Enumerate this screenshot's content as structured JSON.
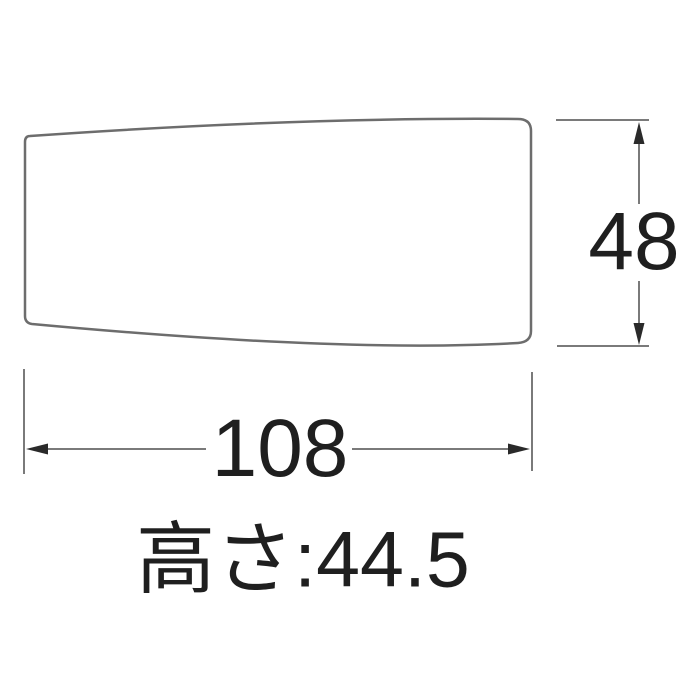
{
  "diagram": {
    "type": "technical-dimension-drawing",
    "part": "tapered-handle-side-view",
    "background_color": "#ffffff",
    "colors": {
      "outline": "#6d6d6d",
      "dimension_line": "#7a7a7a",
      "arrow": "#2a2a2a",
      "text": "#1f1f1f"
    },
    "dims": {
      "height": {
        "label": "48",
        "value": 48,
        "orientation": "vertical",
        "position": "right"
      },
      "width": {
        "label": "108",
        "value": 108,
        "orientation": "horizontal",
        "position": "bottom"
      }
    },
    "caption": {
      "text": "高さ:44.5",
      "meaning": "height: 44.5"
    }
  }
}
